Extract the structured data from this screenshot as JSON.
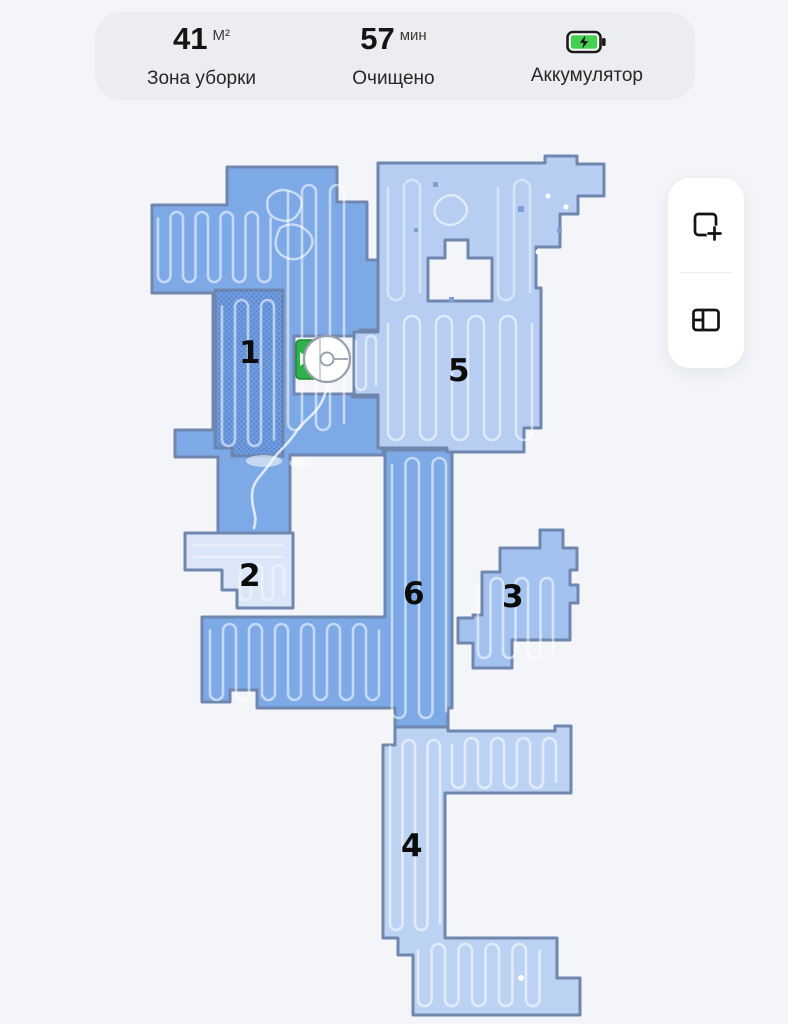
{
  "status_bar": {
    "cleaning_area": {
      "value": "41",
      "unit": "М²",
      "label": "Зона уборки"
    },
    "cleaned_time": {
      "value": "57",
      "unit": "мин",
      "label": "Очищено"
    },
    "battery": {
      "label": "Аккумулятор",
      "icon": "battery-charging-icon",
      "level_color": "#46d053"
    }
  },
  "map": {
    "rooms": [
      {
        "id": 1,
        "label": "1",
        "style": "selected-dotted"
      },
      {
        "id": 2,
        "label": "2",
        "style": "pale"
      },
      {
        "id": 3,
        "label": "3",
        "style": "light-medium"
      },
      {
        "id": 4,
        "label": "4",
        "style": "light"
      },
      {
        "id": 5,
        "label": "5",
        "style": "light"
      },
      {
        "id": 6,
        "label": "6",
        "style": "medium"
      }
    ],
    "robot": {
      "icon": "robot-vacuum-icon"
    },
    "dock": {
      "icon": "charging-dock-icon",
      "color": "#2fb14c"
    }
  },
  "side_toolbar": {
    "buttons": [
      {
        "name": "add-zone",
        "icon": "add-zone-icon"
      },
      {
        "name": "split-rooms",
        "icon": "room-divider-icon"
      }
    ]
  },
  "colors": {
    "accent_green": "#2fb14c",
    "battery_green": "#46d053",
    "room_light": "#b7cdf2",
    "room_medium": "#7ea9e7",
    "room_dark": "#6f9bdf",
    "room_pale": "#dbe6f8",
    "room_light_medium": "#a4c2ef",
    "wall": "#6f86af",
    "background": "#f3f5f8"
  }
}
